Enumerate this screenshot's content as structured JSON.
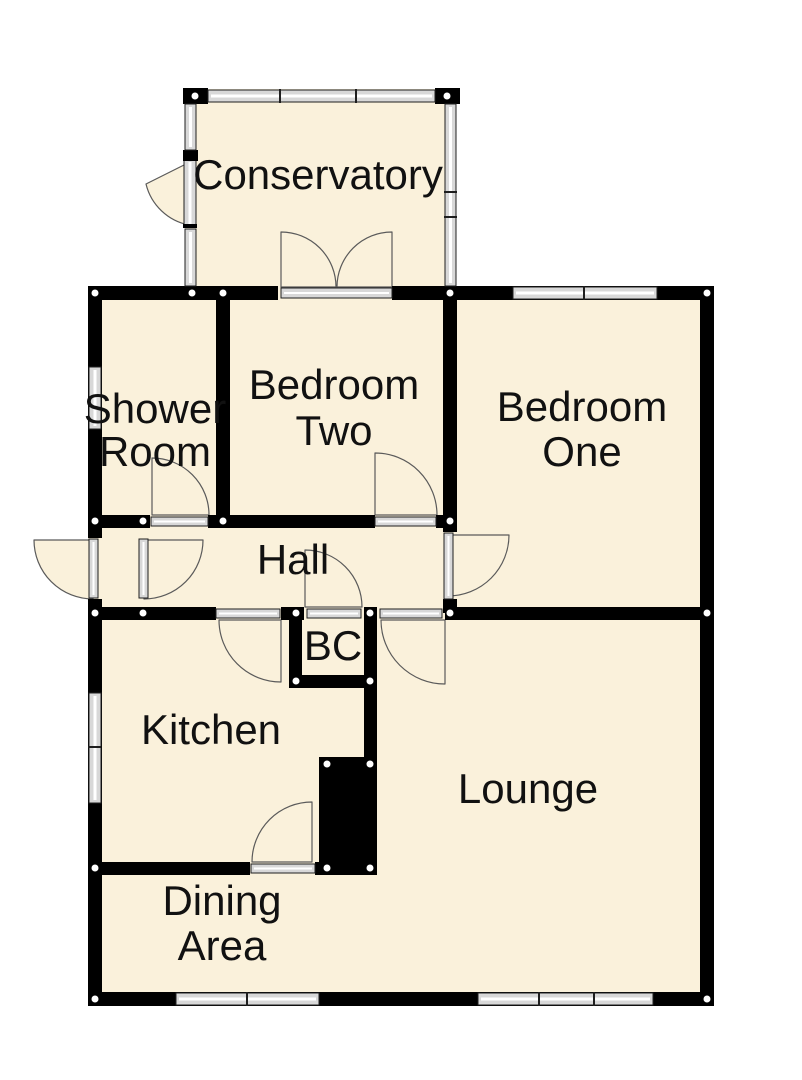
{
  "plan": {
    "colors": {
      "wall": "#000000",
      "floor": "#FAF1DB",
      "window_fill": "#D8D8D8",
      "window_edge": "#1F1F1F",
      "door_arc": "#5A5A5A",
      "node": "#FFFFFF",
      "label": "#111111"
    },
    "rooms": {
      "conservatory": {
        "label": "Conservatory"
      },
      "shower_room": {
        "line1": "Shower",
        "line2": "Room"
      },
      "bedroom_two": {
        "line1": "Bedroom",
        "line2": "Two"
      },
      "bedroom_one": {
        "line1": "Bedroom",
        "line2": "One"
      },
      "hall": {
        "label": "Hall"
      },
      "boiler_cupboard": {
        "label": "BC"
      },
      "kitchen": {
        "label": "Kitchen"
      },
      "lounge": {
        "label": "Lounge"
      },
      "dining_area": {
        "line1": "Dining",
        "line2": "Area"
      }
    }
  }
}
